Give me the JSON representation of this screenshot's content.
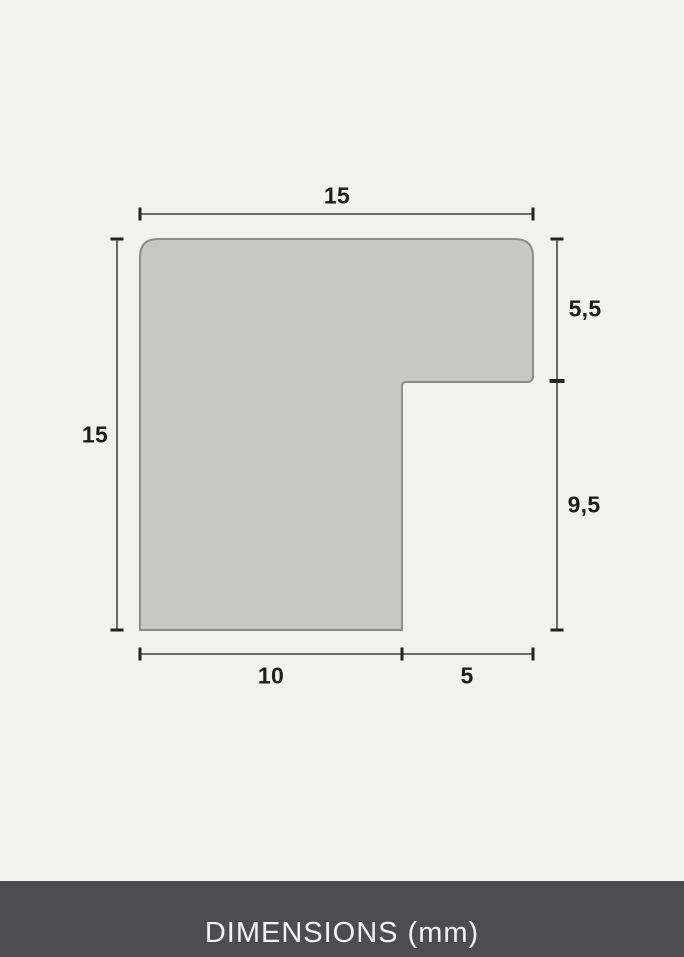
{
  "diagram": {
    "type": "frame-moulding-profile-cross-section",
    "labels": {
      "top_width": "15",
      "left_height": "15",
      "right_upper_depth": "5,5",
      "right_lower_depth": "9,5",
      "bottom_left_width": "10",
      "bottom_right_width": "5"
    },
    "colors": {
      "background": "#f1f1f0",
      "profile_fill": "#c7c7c6",
      "profile_stroke": "#8c8c8b",
      "dimension_line": "#5a5a5a",
      "tick": "#222222",
      "label_text": "#1d1d1d"
    }
  },
  "footer": {
    "label": "DIMENSIONS (mm)",
    "background": "#4d4d4f",
    "text_color": "#f3f3f3"
  }
}
